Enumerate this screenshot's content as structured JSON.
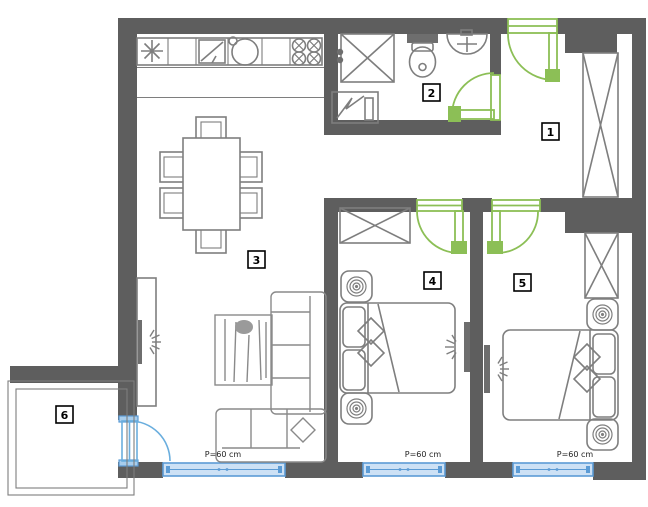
{
  "floorplan": {
    "type": "apartment-floor-plan",
    "rooms": [
      {
        "label": "1",
        "name": "hallway"
      },
      {
        "label": "2",
        "name": "bathroom"
      },
      {
        "label": "3",
        "name": "living-room-kitchen"
      },
      {
        "label": "4",
        "name": "bedroom-1"
      },
      {
        "label": "5",
        "name": "bedroom-2"
      },
      {
        "label": "6",
        "name": "balcony"
      }
    ],
    "windows": [
      {
        "label": "P=60 cm",
        "location": "living-room"
      },
      {
        "label": "P=60 cm",
        "location": "bedroom-1"
      },
      {
        "label": "P=60 cm",
        "location": "bedroom-2"
      }
    ],
    "colors": {
      "wall": "#5e5e5e",
      "furniture_line": "#7e7e7e",
      "door_green": "#8cbf56",
      "window_frame": "#5b9bd5",
      "window_fill": "#cde1f5",
      "balcony_door_blue": "#6aaede",
      "background": "#ffffff",
      "label_text": "#000000"
    },
    "fixtures": {
      "kitchen": [
        "star-symbol",
        "refrigerator",
        "round-sink",
        "cooktop-4-burner"
      ],
      "bathroom": [
        "shower-cabin",
        "washing-machine",
        "toilet",
        "washbasin"
      ],
      "hallway": [
        "wardrobe"
      ],
      "living_room": [
        "dining-table",
        "six-chairs",
        "tv-unit",
        "cabinet",
        "corner-sofa"
      ],
      "bedroom_1": [
        "wardrobe",
        "double-bed",
        "two-nightstands",
        "tv"
      ],
      "bedroom_2": [
        "wardrobe",
        "double-bed",
        "two-nightstands",
        "tv"
      ]
    }
  }
}
